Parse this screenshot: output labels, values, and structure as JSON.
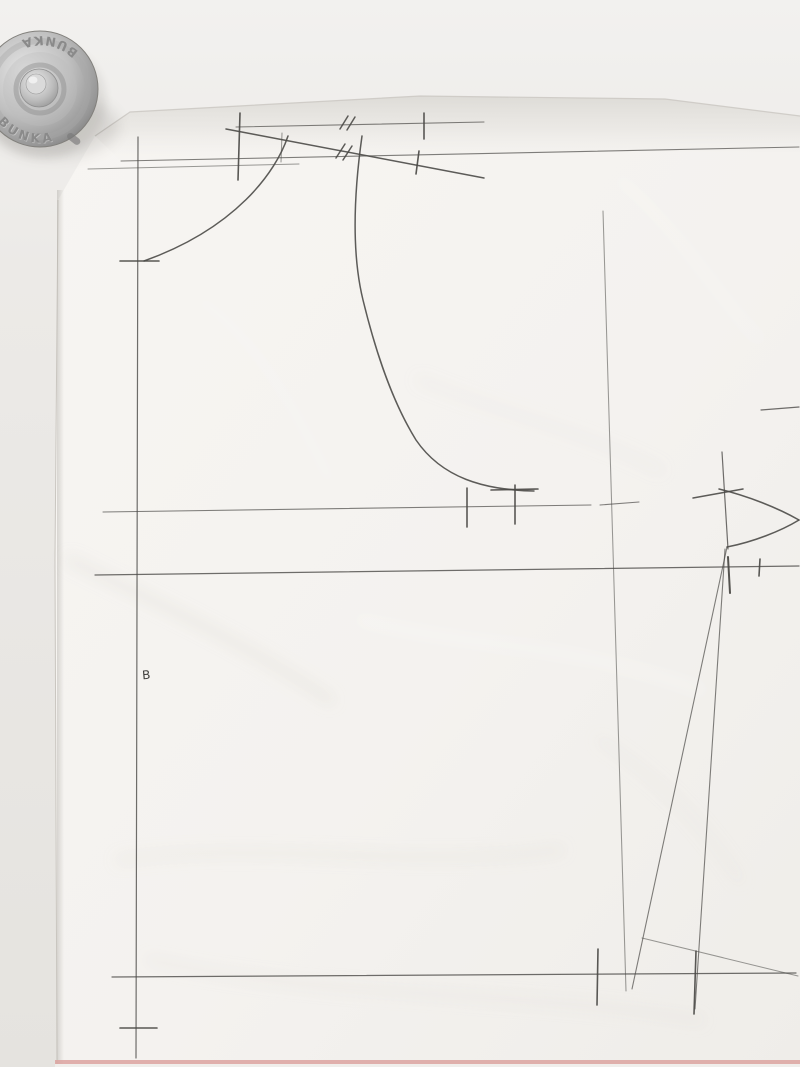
{
  "scene": {
    "description": "Photograph of a hand-drawn sewing pattern draft in pencil on white paper, held down by a round metal pattern weight at top left",
    "paper_label": "B"
  },
  "weight": {
    "brand_top": "BUNKA",
    "brand_bottom": "BUNKA"
  },
  "pattern": {
    "label_b": "B"
  },
  "colors": {
    "paper": "#f5f3f0",
    "table": "#eae8e4",
    "pencil": "#4b4a47",
    "metal": "#b5b5b5",
    "bottom_edge_pink": "#dca3a0"
  }
}
